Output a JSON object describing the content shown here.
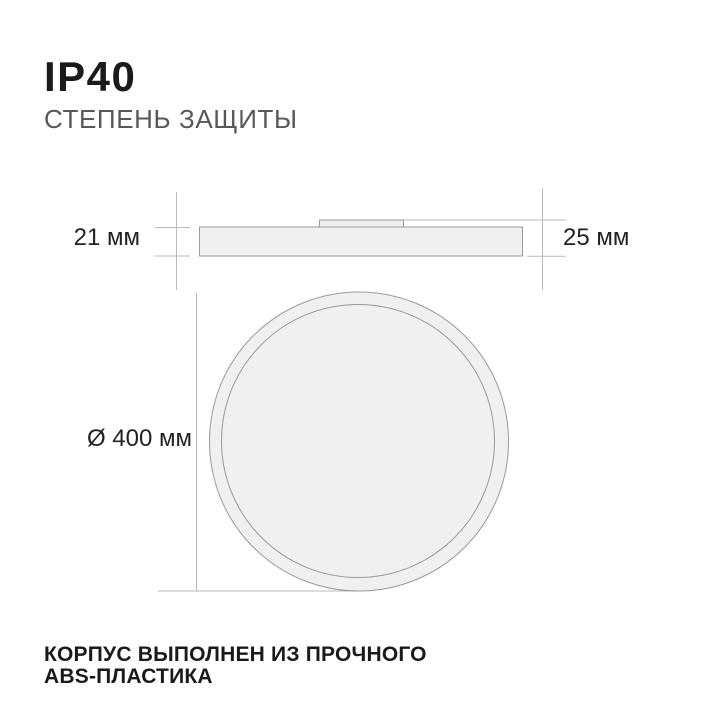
{
  "header": {
    "title": "IP40",
    "subtitle": "СТЕПЕНЬ ЗАЩИТЫ"
  },
  "diagram": {
    "side_view": {
      "body_height_label": "21 мм",
      "total_height_label": "25 мм"
    },
    "front_view": {
      "diameter_label": "Ø 400 мм"
    }
  },
  "footer": {
    "line1": "КОРПУС ВЫПОЛНЕН ИЗ ПРОЧНОГО",
    "line2": "ABS-ПЛАСТИКА"
  },
  "colors": {
    "text_primary": "#1a1a1a",
    "text_secondary": "#57585a",
    "shape_fill": "#f0f0f1",
    "shape_stroke": "#9a9a9a",
    "dimension_line": "#b9b9b9"
  }
}
